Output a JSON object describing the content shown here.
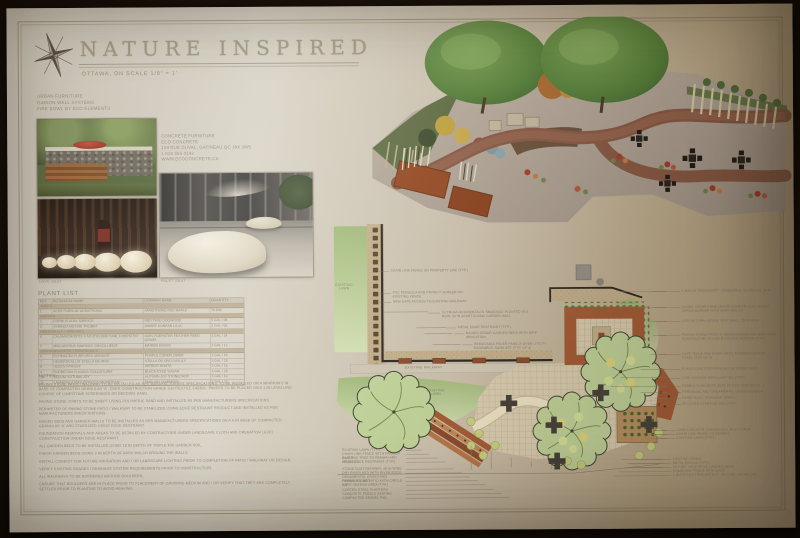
{
  "palette": {
    "paper": "#cdc2ae",
    "ink": "#8e8270",
    "wall": "#2c2822",
    "lawn": "#aec687",
    "tan": "#c6b28d",
    "rust": "#a65c36",
    "paver": "#dcd0b3",
    "tree": "#c3d69c"
  },
  "header": {
    "title": "NATURE INSPIRED",
    "subtitle": "OTTAWA, ON      SCALE 1/8\" = 1'",
    "compass_icon": "compass-rose"
  },
  "furniture": {
    "urban_lines": [
      "URBAN FURNITURE",
      "GABION WALL SYSTEMS",
      "FIRE BOWL BY ECO ELEMENTS"
    ],
    "concrete_lines": [
      "CONCRETE FURNITURE",
      "ECO CONCRETE",
      "104 RUE DUVAL, GATINEAU QC J8X 2W5",
      "1 819 555 0142",
      "WWW.ECOCONCRETE.CA"
    ],
    "caption_photo2": "LOVE SEAT",
    "caption_photo3": "PALET SEAT"
  },
  "plant_list": {
    "title": "PLANT LIST",
    "columns": [
      "KEY",
      "BOTANICAL NAME",
      "COMMON NAME",
      "QUANTITY"
    ],
    "groups": [
      {
        "section": "TREES",
        "rows": [
          [
            "1",
            "ACER RUBRUM 'ARMSTRONG'",
            "ARMSTRONG RED MAPLE",
            "70 MM"
          ]
        ]
      },
      {
        "section": "SHRUBS",
        "rows": [
          [
            "2",
            "CORNUS ALBA 'SIBIRICA'",
            "RED TWIG DOGWOOD",
            "5 GAL / 08"
          ],
          [
            "3",
            "SYRINGA MEYERI 'PALIBIN'",
            "DWARF KOREAN LILAC",
            "2 GAL / 06"
          ]
        ]
      },
      {
        "section": "PERENNIALS / GRASSES",
        "rows": [
          [
            "4",
            "CALAMAGROSTIS X ACUTIFLORA 'KARL FOERSTER'",
            "KARL FOERSTER FEATHER REED GRASS",
            "1 GAL / 24"
          ],
          [
            "5",
            "MISCANTHUS SINENSIS 'GRACILLIMUS'",
            "MAIDEN GRASS",
            "1 GAL / 12"
          ]
        ]
      },
      {
        "section": "GROUNDCOVERS / PERENNIALS",
        "rows": [
          [
            "6",
            "ECHINACEA PURPUREA 'MAGNUS'",
            "PURPLE CONEFLOWER",
            "1 GAL / 18"
          ],
          [
            "7",
            "HEMEROCALLIS 'STELLA DE ORO'",
            "STELLA DE ORO DAYLILY",
            "1 GAL / 24"
          ],
          [
            "8",
            "HOSTA 'PATRIOT'",
            "PATRIOT HOSTA",
            "1 GAL / 16"
          ],
          [
            "9",
            "RUDBECKIA FULGIDA 'GOLDSTURM'",
            "BLACK-EYED SUSAN",
            "1 GAL / 20"
          ],
          [
            "10",
            "SEDUM 'AUTUMN JOY'",
            "AUTUMN JOY STONECROP",
            "1 GAL / 14"
          ],
          [
            "11",
            "LAVANDULA ANGUSTIFOLIA 'MUNSTEAD'",
            "ENGLISH LAVENDER",
            "1 GAL / 12"
          ]
        ]
      }
    ]
  },
  "notes": {
    "title": "NOTES",
    "items": [
      "PAVING STONE PATIO / WALKWAY TO BE INSTALLED AS PER MANUFACTURERS SPECIFICATIONS. TO BE INSTALLED ON A MINIMUM 6 IN BASE OF COMPACTED GRANULAR 'A', OVER CONSTRUCTION GRADE GEOTEXTILE FABRIC. PAVERS TO BE PLACED ON A 1 IN LEVELLING COURSE OF LIMESTONE SCREENINGS OR BEDDING SAND.",
      "PAVING STONE JOINTS TO BE SWEPT USING POLYMERIC SAND AND INSTALLED AS PER MANUFACTURERS SPECIFICATIONS.",
      "PERIMETER OF PAVING STONE PATIO / WALKWAY TO BE STABILIZED USING EDGE RESTRAINT PRODUCT AND INSTALLED AS PER MANUFACTURERS SPECIFICATIONS.",
      "RAISED BEDS AND GARDEN WALLS TO BE INSTALLED AS PER MANUFACTURERS SPECIFICATIONS ON A 6 IN BASE OF COMPACTED GRANULAR 'A' AND STABILIZED USING EDGE RESTRAINT.",
      "FOUNDATION REMOVALS AND AREAS TO BE DETAILED BY CONTRACTORS UNDER LANDSCAPE CLOTH AND OPERATION LEVEL CONSTRUCTION UNDER EDGE RESTRAINT.",
      "ALL GARDEN BEDS TO BE INSTALLED USING 18 IN DEPTH OF TRIPLE MIX GARDEN SOIL.",
      "FINISH GARDEN BEDS USING 3 IN DEPTH OF BARK MULCH AROUND THE WALLS.",
      "INSTALL CONDUIT FOR FUTURE IRRIGATION AND / OR LANDSCAPE LIGHTING PRIOR TO COMPLETION OF PATIO / WALKWAY OR DESIGN.",
      "VERIFY EXISTING GRADES / DRAINAGE SYSTEM REQUIREMENTS PRIOR TO CONSTRUCTION.",
      "ALL WALKWAYS TO BE BORDERED AROUND BOULDERS.",
      "ENSURE THAT BOULDERS ARE IN PLACE PRIOR TO PLACEMENT OF GROWING MEDIUM AND / OR VERIFY THAT THEY ARE COMPLETELY SETTLED PRIOR TO PLANTING TO AVOID HEAVING."
    ]
  },
  "plan": {
    "labels": [
      {
        "x": 322,
        "y": 277,
        "w": 28,
        "t": "EXISTING\nLAWN"
      },
      {
        "x": 413,
        "y": 383,
        "w": 28,
        "t": "EXISTING\nLAWN"
      },
      {
        "x": 604,
        "y": 297,
        "w": 28,
        "t": "EXISTING\nLAWN"
      },
      {
        "x": 393,
        "y": 360,
        "w": 44,
        "t": "EXISTING WALKWAY"
      }
    ],
    "callouts": [
      {
        "x": 381,
        "y": 263,
        "lead": 11,
        "w": 84,
        "side": "l",
        "t": "CHAIN LINK FENCE ON PROPERTY LINE (TYP.)"
      },
      {
        "x": 383,
        "y": 285,
        "lead": 12,
        "w": 86,
        "side": "l",
        "t": "PVC PERGOLA AND PRIVACY SCREEN ON EXISTING FENCE"
      },
      {
        "x": 383,
        "y": 294,
        "lead": 12,
        "w": 84,
        "side": "l",
        "t": "NEW GATE ACCESS TO EXISTING WALKWAY"
      },
      {
        "x": 432,
        "y": 305,
        "lead": 12,
        "w": 88,
        "side": "l",
        "t": "18 THUJA OCCIDENTALIS 'SMARAGD' PLANTED IN A ROW, 30 IN APART ALONG GARDEN WALL"
      },
      {
        "x": 448,
        "y": 320,
        "lead": 10,
        "w": 70,
        "side": "l",
        "t": "METAL EDGE RESTRAINT (TYP.)"
      },
      {
        "x": 456,
        "y": 326,
        "lead": 10,
        "w": 72,
        "side": "l",
        "t": "RAISED CEDAR GARDEN BEDS WITH DRIP IRRIGATION"
      },
      {
        "x": 464,
        "y": 337,
        "lead": 10,
        "w": 74,
        "side": "l",
        "t": "REMOVABLE PAVER PANELS OVER UTILITY EASEMENT, SAND SET (TYP. OF 4)"
      },
      {
        "x": 672,
        "y": 285,
        "lead": 28,
        "w": 92,
        "side": "l",
        "t": "1 MALUS 'SNOWDRIFT' CRABAPPLE, 60 MM CAL. B+B"
      },
      {
        "x": 672,
        "y": 301,
        "lead": 26,
        "w": 94,
        "side": "l",
        "t": "GLOBE CEDARS AND DWARF KOREAN LILAC MIXED SHRUB BORDER WITH BARK MULCH"
      },
      {
        "x": 672,
        "y": 315,
        "lead": 24,
        "w": 94,
        "side": "l",
        "t": "LOW NATURAL STONE SEAT WALL, 18 IN HIGH"
      },
      {
        "x": 672,
        "y": 329,
        "lead": 22,
        "w": 94,
        "side": "l",
        "t": "PAVING STONE PATIO IN HERRINGBONE PATTERN WITH CONTRASTING SOLDIER COURSE BORDER (TYP.)"
      },
      {
        "x": 672,
        "y": 348,
        "lead": 20,
        "w": 94,
        "side": "l",
        "t": "CAFE TABLE AND CHAIR SETS, POWDER COATED STEEL (TYP. OF 5)"
      },
      {
        "x": 672,
        "y": 363,
        "lead": 18,
        "w": 94,
        "side": "l",
        "t": "FLAGSTONE STEPPERS SET IN STONE DUST"
      },
      {
        "x": 672,
        "y": 372,
        "lead": 16,
        "w": 94,
        "side": "l",
        "t": "LOW VOLTAGE PATH LIGHTING (TYP.)"
      },
      {
        "x": 672,
        "y": 380,
        "lead": 15,
        "w": 94,
        "side": "l",
        "t": "PEBBLE CONCRETE SEAT BY ECO CONCRETE"
      },
      {
        "x": 672,
        "y": 386,
        "lead": 15,
        "w": 94,
        "side": "l",
        "t": "PERENNIAL AND ORNAMENTAL GRASS BORDER"
      },
      {
        "x": 672,
        "y": 392,
        "lead": 13,
        "w": 94,
        "side": "l",
        "t": "RIVER ROCK DRAINAGE SWALE"
      },
      {
        "x": 672,
        "y": 398,
        "lead": 13,
        "w": 94,
        "side": "l",
        "t": "MULCHED PLANTING BED (TYP.)"
      },
      {
        "x": 666,
        "y": 424,
        "lead": 22,
        "w": 92,
        "side": "l",
        "t": "1 AMELANCHIER CANADENSIS, MULTI-STEM"
      },
      {
        "x": 666,
        "y": 428,
        "lead": 26,
        "w": 92,
        "side": "l",
        "t": "CHAIN LINK FENCE TO REMAIN"
      },
      {
        "x": 666,
        "y": 432,
        "lead": 30,
        "w": 92,
        "side": "l",
        "t": "EXISTING LAWN (TYP.)"
      },
      {
        "x": 662,
        "y": 453,
        "lead": 34,
        "w": 94,
        "side": "l",
        "t": "EXISTING FENCE"
      },
      {
        "x": 662,
        "y": 457,
        "lead": 40,
        "w": 94,
        "side": "l",
        "t": "METAL EDGING (TYP.)"
      },
      {
        "x": 662,
        "y": 461,
        "lead": 46,
        "w": 94,
        "side": "l",
        "t": "FUTURE VEGETABLE GARDEN BEDS"
      },
      {
        "x": 662,
        "y": 465,
        "lead": 52,
        "w": 94,
        "side": "l",
        "t": "CHAIN LINK FENCE WITH GATE"
      },
      {
        "x": 662,
        "y": 469,
        "lead": 58,
        "w": 94,
        "side": "l",
        "t": "1 GLEDITSIA TRIACANTHOS 'SKYLINE', 60 MM CAL."
      },
      {
        "x": 333,
        "y": 442,
        "lead": 16,
        "w": 62,
        "side": "r",
        "t": "EXISTING LAWN (TYP.)"
      },
      {
        "x": 333,
        "y": 446,
        "lead": 24,
        "w": 62,
        "side": "r",
        "t": "CHAIN LINK FENCE WITH PRIVACY SLATS"
      },
      {
        "x": 333,
        "y": 450,
        "lead": 32,
        "w": 62,
        "side": "r",
        "t": "EXISTING TREE TO REMAIN AND PROTECT"
      },
      {
        "x": 333,
        "y": 454,
        "lead": 40,
        "w": 62,
        "side": "r",
        "t": "METAL EDGE RESTRAINT (TYP.)"
      },
      {
        "x": 333,
        "y": 461,
        "lead": 48,
        "w": 62,
        "side": "r",
        "t": "STONE DUST PATHWAY, 48 IN WIDE"
      },
      {
        "x": 333,
        "y": 465,
        "lead": 56,
        "w": 62,
        "side": "r",
        "t": "DRY RIVER BED WITH RIVER ROCK"
      },
      {
        "x": 333,
        "y": 469,
        "lead": 64,
        "w": 62,
        "side": "r",
        "t": "ORNAMENTAL GRASS AND PERENNIAL BED"
      },
      {
        "x": 333,
        "y": 473,
        "lead": 72,
        "w": 62,
        "side": "r",
        "t": "PAVING STONE PATIO WITH CIRCLE KIT"
      },
      {
        "x": 333,
        "y": 477,
        "lead": 80,
        "w": 62,
        "side": "r",
        "t": "CAFE SEATING AREA (TYP.)"
      },
      {
        "x": 333,
        "y": 482,
        "lead": 88,
        "w": 62,
        "side": "r",
        "t": "CORTEN STEEL PLANTERS"
      },
      {
        "x": 333,
        "y": 486,
        "lead": 96,
        "w": 62,
        "side": "r",
        "t": "CONCRETE PEBBLE SEATING"
      },
      {
        "x": 333,
        "y": 490,
        "lead": 104,
        "w": 62,
        "side": "r",
        "t": "COMPACTED GRAVEL PAD"
      }
    ]
  }
}
